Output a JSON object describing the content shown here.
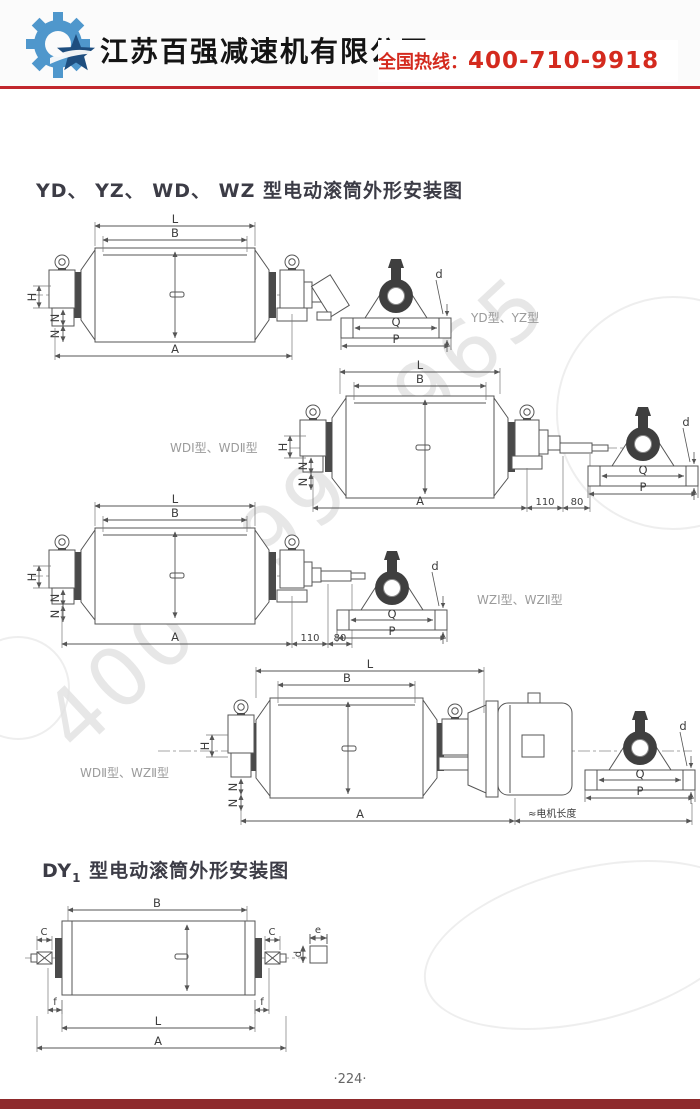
{
  "header": {
    "company": "江苏百强减速机有限公司",
    "hotline_label": "全国热线：",
    "hotline_number": "400-710-9918"
  },
  "watermark": {
    "text": "400-799-9965"
  },
  "sections": {
    "s1": {
      "title": "YD、 YZ、 WD、 WZ 型电动滚筒外形安装图"
    },
    "s2": {
      "prefix": "DY",
      "sub": "1",
      "rest": "型电动滚筒外形安装图"
    }
  },
  "dims": {
    "L": "L",
    "B": "B",
    "A": "A",
    "H": "H",
    "N": "N",
    "Q": "Q",
    "P": "P",
    "d": "d",
    "e": "e",
    "C": "C",
    "f": "f",
    "n110": "110",
    "n80": "80",
    "motor_length": "≈电机长度"
  },
  "captions": {
    "c1": "YD型、YZ型",
    "c2": "WDⅠ型、WDⅡ型",
    "c3": "WZⅠ型、WZⅡ型",
    "c4": "WDⅡ型、WZⅡ型"
  },
  "footer": {
    "page_number": "·224·"
  },
  "colors": {
    "accent_red": "#c1272d",
    "hotline_red": "#d42a1e",
    "bottom_bar_red": "#8e2a2c",
    "logo_blue": "#4f97cc",
    "logo_dark_blue": "#1e4e7f",
    "line_gray": "#555555",
    "watermark_gray": "#d4d4d4"
  }
}
